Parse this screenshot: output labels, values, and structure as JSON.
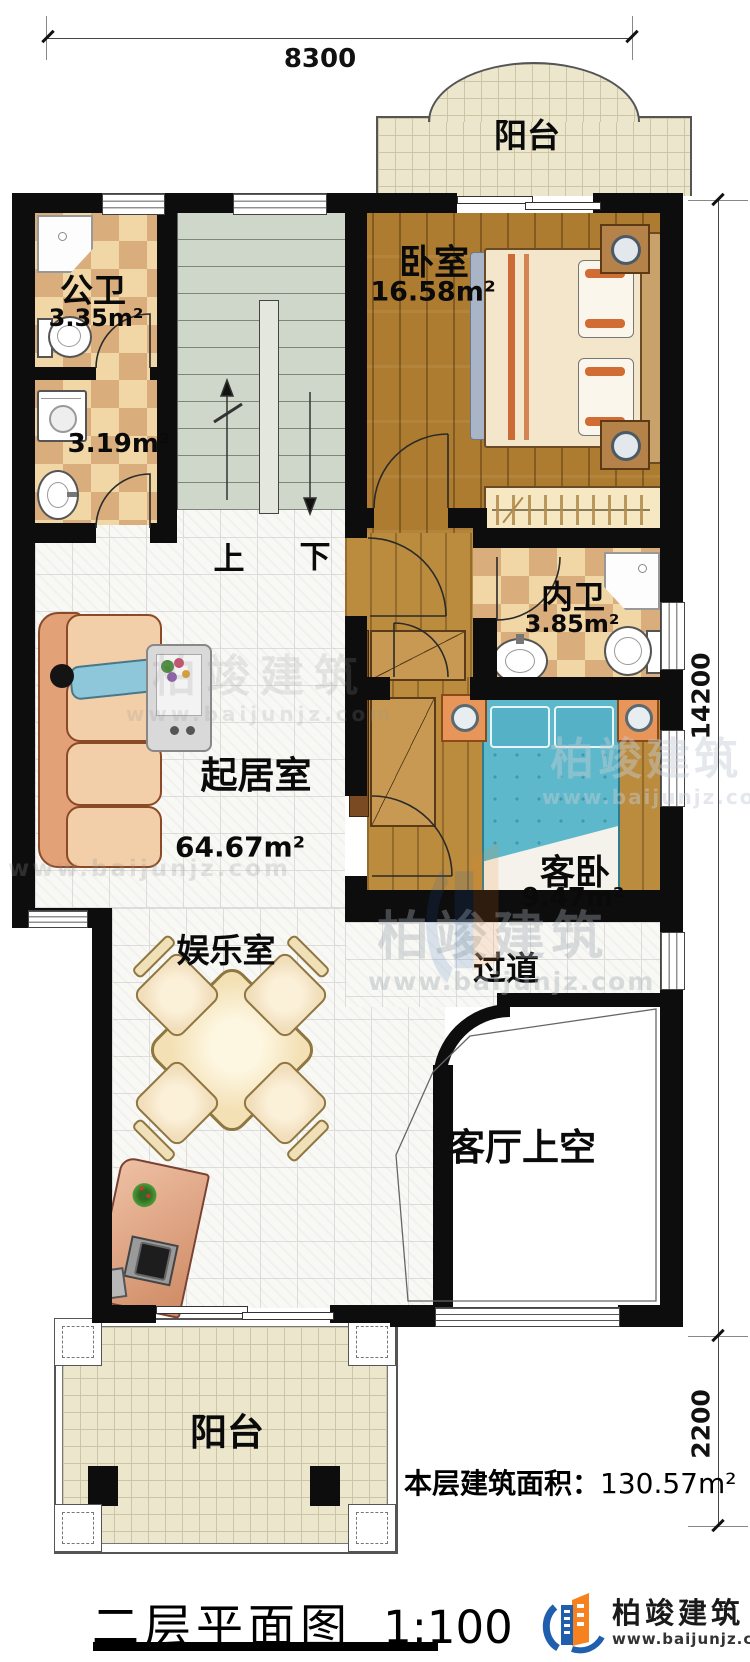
{
  "dims": {
    "width_top": "8300",
    "height_main": "14200",
    "height_lower": "2200"
  },
  "rooms": {
    "balcony_top": {
      "label": "阳台"
    },
    "bedroom": {
      "label": "卧室",
      "area": "16.58m²"
    },
    "public_bath": {
      "label": "公卫",
      "area": "3.35m²"
    },
    "laundry": {
      "area": "3.19m²"
    },
    "ensuite_bath": {
      "label": "内卫",
      "area": "3.85m²"
    },
    "living": {
      "label": "起居室",
      "area": "64.67m²"
    },
    "guest_bedroom": {
      "label": "客卧",
      "area": "9.47m²"
    },
    "corridor": {
      "label": "过道"
    },
    "entertainment": {
      "label": "娱乐室"
    },
    "living_void": {
      "label": "客厅上空"
    },
    "balcony_bottom": {
      "label": "阳台"
    }
  },
  "stairs": {
    "up": "上",
    "down": "下"
  },
  "footer": {
    "area_label": "本层建筑面积：",
    "area_value": "130.57m²",
    "title": "二层平面图",
    "scale": "1:100"
  },
  "branding": {
    "company": "柏竣建筑",
    "website": "www.baijunjz.com"
  }
}
